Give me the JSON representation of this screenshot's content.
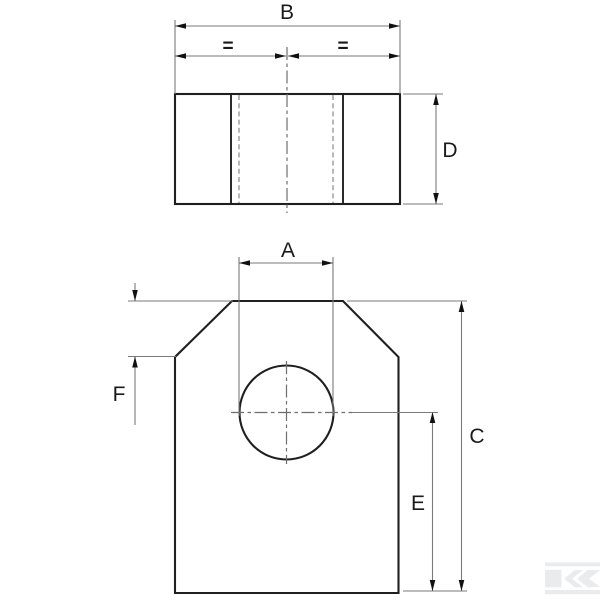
{
  "drawing": {
    "kind": "engineering-drawing-two-views",
    "subject": "clevis plate with chamfered corners and center hole",
    "labels": {
      "A": "A",
      "B": "B",
      "C": "C",
      "D": "D",
      "E": "E",
      "F": "F",
      "eq_left": "=",
      "eq_right": "="
    },
    "dimensions": [
      {
        "id": "B",
        "label": "B",
        "view": "top",
        "orientation": "horizontal",
        "spans": "overall width"
      },
      {
        "id": "eq_left",
        "label": "=",
        "view": "top",
        "orientation": "horizontal",
        "spans": "left half of B"
      },
      {
        "id": "eq_right",
        "label": "=",
        "view": "top",
        "orientation": "horizontal",
        "spans": "right half of B"
      },
      {
        "id": "D",
        "label": "D",
        "view": "top",
        "orientation": "vertical",
        "spans": "top-view depth"
      },
      {
        "id": "A",
        "label": "A",
        "view": "front",
        "orientation": "horizontal",
        "spans": "hole width"
      },
      {
        "id": "F",
        "label": "F",
        "view": "front",
        "orientation": "vertical",
        "spans": "chamfer height"
      },
      {
        "id": "E",
        "label": "E",
        "view": "front",
        "orientation": "vertical",
        "spans": "hole center to bottom edge"
      },
      {
        "id": "C",
        "label": "C",
        "view": "front",
        "orientation": "vertical",
        "spans": "overall height"
      }
    ],
    "watermark": {
      "icon": "kramp-k-logo"
    },
    "colors": {
      "background": "#ffffff",
      "outline": "#1f1f1f",
      "thin_line": "#7a7a7a",
      "hidden_line": "#999999",
      "centerline": "#6e6e6e",
      "arrow": "#111111",
      "label": "#1a1a1a",
      "watermark": "#eaebed"
    }
  }
}
